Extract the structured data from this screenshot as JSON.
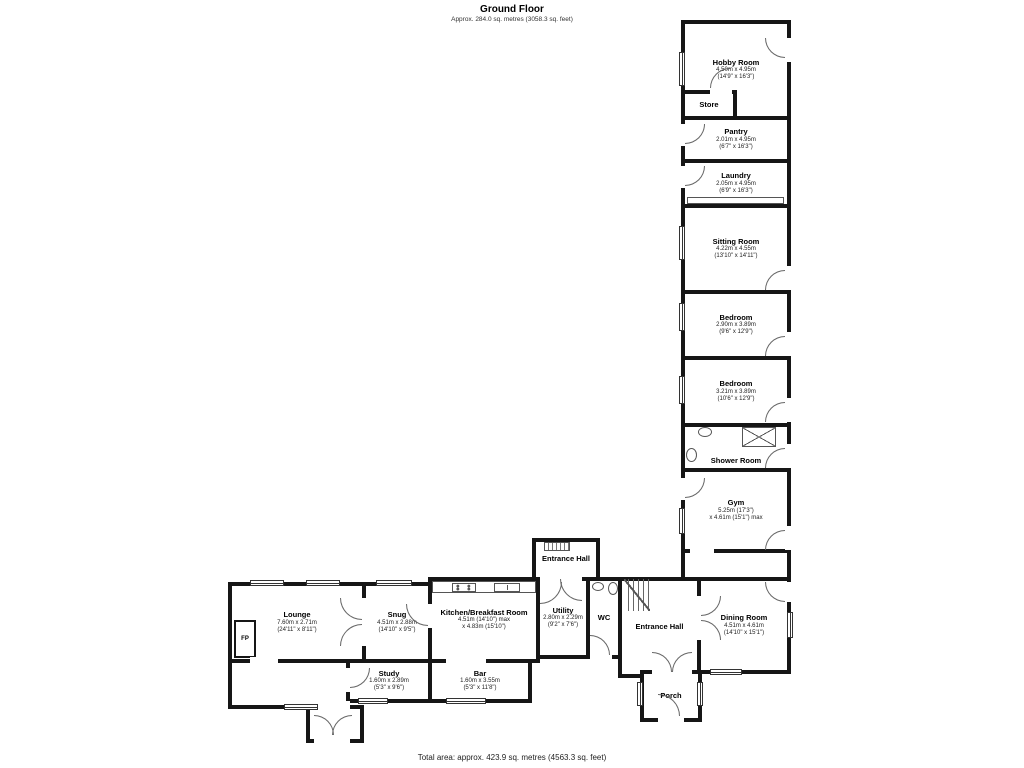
{
  "header": {
    "title": "Ground Floor",
    "subtitle": "Approx. 284.0 sq. metres (3058.3 sq. feet)"
  },
  "footer": {
    "total_area": "Total area: approx. 423.9 sq. metres (4563.3 sq. feet)"
  },
  "rooms": {
    "hobby": {
      "name": "Hobby Room",
      "dims1": "4.50m x 4.95m",
      "dims2": "(14'9\" x 16'3\")"
    },
    "store": {
      "name": "Store"
    },
    "pantry": {
      "name": "Pantry",
      "dims1": "2.01m x 4.95m",
      "dims2": "(6'7\" x 16'3\")"
    },
    "laundry": {
      "name": "Laundry",
      "dims1": "2.05m x 4.95m",
      "dims2": "(6'9\" x 16'3\")"
    },
    "sitting": {
      "name": "Sitting Room",
      "dims1": "4.22m x 4.55m",
      "dims2": "(13'10\" x 14'11\")"
    },
    "bedroom1": {
      "name": "Bedroom",
      "dims1": "2.90m x 3.89m",
      "dims2": "(9'6\" x 12'9\")"
    },
    "bedroom2": {
      "name": "Bedroom",
      "dims1": "3.21m x 3.89m",
      "dims2": "(10'6\" x 12'9\")"
    },
    "shower": {
      "name": "Shower Room"
    },
    "gym": {
      "name": "Gym",
      "dims1": "5.25m (17'3\")",
      "dims2": "x 4.61m (15'1\") max"
    },
    "dining": {
      "name": "Dining Room",
      "dims1": "4.51m x 4.61m",
      "dims2": "(14'10\" x 15'1\")"
    },
    "ehall": {
      "name": "Entrance Hall"
    },
    "ehalltop": {
      "name": "Entrance Hall"
    },
    "porch": {
      "name": "Porch"
    },
    "wc": {
      "name": "WC"
    },
    "utility": {
      "name": "Utility",
      "dims1": "2.80m x 2.29m",
      "dims2": "(9'2\" x 7'6\")"
    },
    "kitchen": {
      "name": "Kitchen/Breakfast Room",
      "dims1": "4.51m (14'10\") max",
      "dims2": "x 4.83m (15'10\")"
    },
    "snug": {
      "name": "Snug",
      "dims1": "4.51m x 2.88m",
      "dims2": "(14'10\" x 9'5\")"
    },
    "lounge": {
      "name": "Lounge",
      "dims1": "7.60m x 2.71m",
      "dims2": "(24'11\" x 8'11\")"
    },
    "study": {
      "name": "Study",
      "dims1": "1.60m x 2.89m",
      "dims2": "(5'3\" x 9'6\")"
    },
    "bar": {
      "name": "Bar",
      "dims1": "1.60m x 3.55m",
      "dims2": "(5'3\" x 11'8\")"
    }
  },
  "labels": {
    "fireplace": "FP"
  },
  "colors": {
    "wall": "#161616",
    "line": "#555555",
    "text": "#111111",
    "background": "#ffffff"
  }
}
